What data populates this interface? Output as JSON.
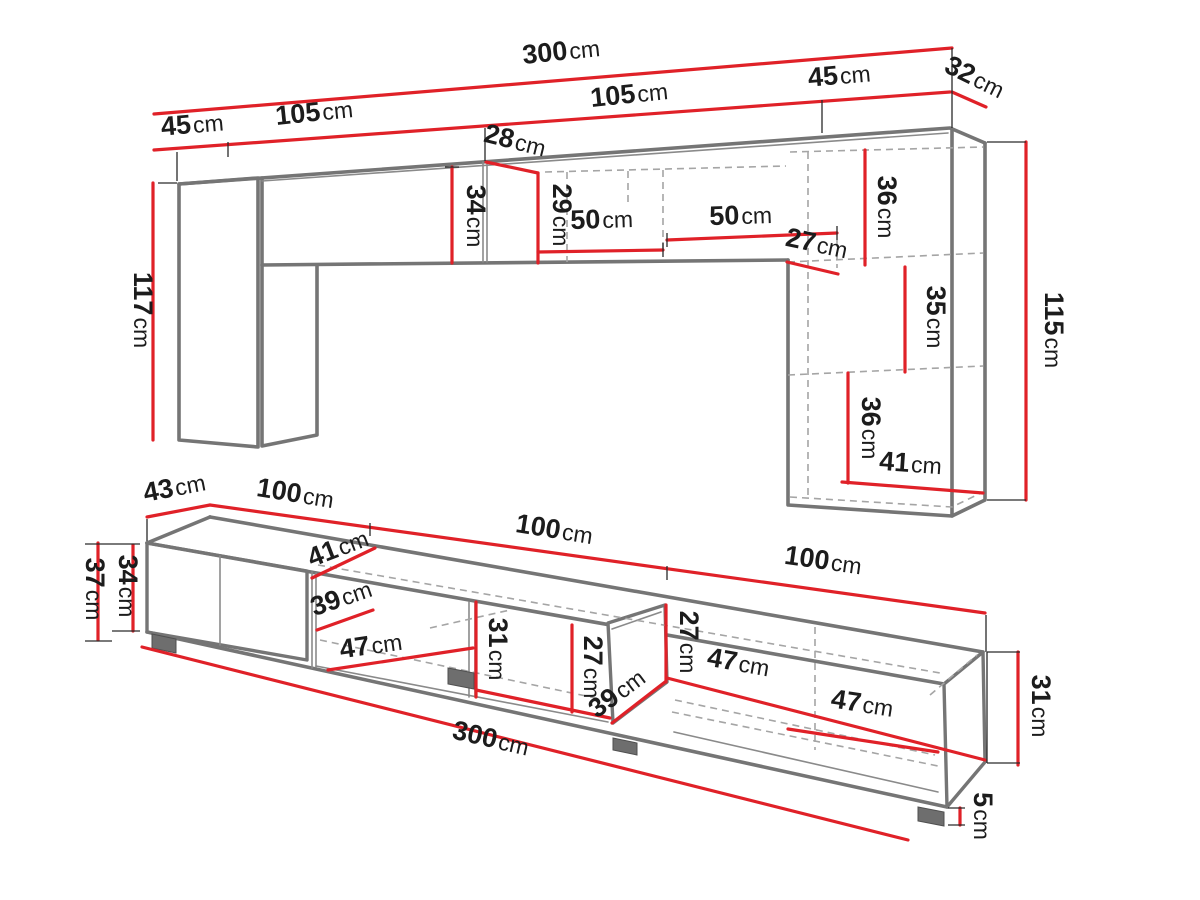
{
  "palette": {
    "bg": "#ffffff",
    "red": "#e02128",
    "gray": "#757575",
    "dash": "#a5a5a5",
    "ink": "#1c1c1c"
  },
  "unit_default": "cm",
  "dims": [
    {
      "id": "top-total-width",
      "value": "300",
      "unit": "cm"
    },
    {
      "id": "top-left-depth",
      "value": "45",
      "unit": "cm"
    },
    {
      "id": "top-segment-1",
      "value": "105",
      "unit": "cm"
    },
    {
      "id": "top-segment-2",
      "value": "105",
      "unit": "cm"
    },
    {
      "id": "top-right-width",
      "value": "45",
      "unit": "cm"
    },
    {
      "id": "top-right-depth",
      "value": "32",
      "unit": "cm"
    },
    {
      "id": "top-notch-depth",
      "value": "28",
      "unit": "cm"
    },
    {
      "id": "top-band-height-left",
      "value": "34",
      "unit": "cm"
    },
    {
      "id": "top-band-height-mid",
      "value": "29",
      "unit": "cm"
    },
    {
      "id": "top-shelf-width-1",
      "value": "50",
      "unit": "cm"
    },
    {
      "id": "top-shelf-width-2",
      "value": "50",
      "unit": "cm"
    },
    {
      "id": "top-drop",
      "value": "27",
      "unit": "cm"
    },
    {
      "id": "top-right-shelf-upper",
      "value": "36",
      "unit": "cm"
    },
    {
      "id": "top-right-shelf-middle",
      "value": "35",
      "unit": "cm"
    },
    {
      "id": "top-right-shelf-lower",
      "value": "36",
      "unit": "cm"
    },
    {
      "id": "top-right-inner-width",
      "value": "41",
      "unit": "cm"
    },
    {
      "id": "top-right-height",
      "value": "115",
      "unit": "cm"
    },
    {
      "id": "top-left-height",
      "value": "117",
      "unit": "cm"
    },
    {
      "id": "stand-depth",
      "value": "43",
      "unit": "cm"
    },
    {
      "id": "stand-section-1",
      "value": "100",
      "unit": "cm"
    },
    {
      "id": "stand-section-2",
      "value": "100",
      "unit": "cm"
    },
    {
      "id": "stand-section-3",
      "value": "100",
      "unit": "cm"
    },
    {
      "id": "stand-height-total",
      "value": "37",
      "unit": "cm"
    },
    {
      "id": "stand-body-height",
      "value": "34",
      "unit": "cm"
    },
    {
      "id": "stand-inner-depth",
      "value": "41",
      "unit": "cm"
    },
    {
      "id": "stand-inner-depth-2",
      "value": "39",
      "unit": "cm"
    },
    {
      "id": "stand-inner-width-1",
      "value": "47",
      "unit": "cm"
    },
    {
      "id": "stand-inner-height-1",
      "value": "31",
      "unit": "cm"
    },
    {
      "id": "stand-inner-height-2",
      "value": "27",
      "unit": "cm"
    },
    {
      "id": "stand-door-height",
      "value": "27",
      "unit": "cm"
    },
    {
      "id": "stand-door-width",
      "value": "39",
      "unit": "cm"
    },
    {
      "id": "stand-inner-width-2",
      "value": "47",
      "unit": "cm"
    },
    {
      "id": "stand-inner-width-3",
      "value": "47",
      "unit": "cm"
    },
    {
      "id": "stand-end-height",
      "value": "31",
      "unit": "cm"
    },
    {
      "id": "stand-total-width",
      "value": "300",
      "unit": "cm"
    },
    {
      "id": "stand-foot-height",
      "value": "5",
      "unit": "cm"
    }
  ]
}
